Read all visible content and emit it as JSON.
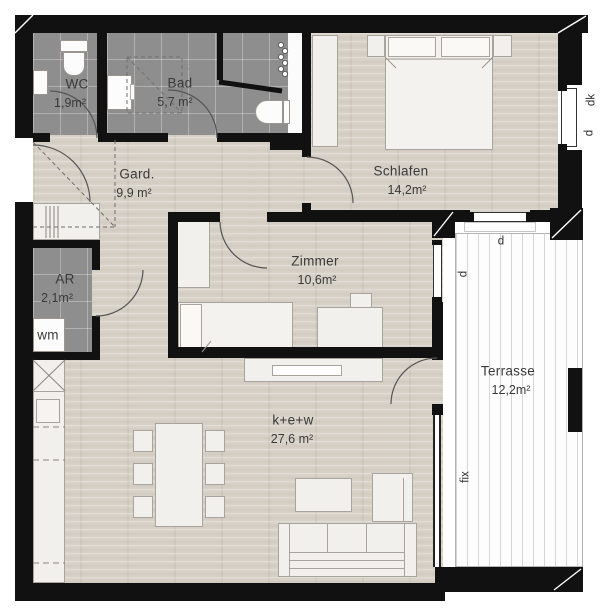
{
  "rooms": [
    {
      "id": "wc",
      "name": "WC",
      "area": "1,9m²"
    },
    {
      "id": "bad",
      "name": "Bad",
      "area": "5,7 m²"
    },
    {
      "id": "gard",
      "name": "Gard.",
      "area": "9,9 m²"
    },
    {
      "id": "schlafen",
      "name": "Schlafen",
      "area": "14,2m²"
    },
    {
      "id": "ar",
      "name": "AR",
      "area": "2,1m²"
    },
    {
      "id": "zimmer",
      "name": "Zimmer",
      "area": "10,6m²"
    },
    {
      "id": "kew",
      "name": "k+e+w",
      "area": "27,6 m²"
    },
    {
      "id": "terrasse",
      "name": "Terrasse",
      "area": "12,2m²"
    }
  ],
  "fixtures": {
    "shower_size": "120/120",
    "washing_machine": "wm"
  },
  "window_labels": {
    "turn_tilt": "dk",
    "turn": "d",
    "fixed": "fix"
  },
  "colors": {
    "wall": "#111111",
    "tile_floor": "#8e8e8e",
    "wood_floor": "#d8d2c8",
    "terrace_floor": "#fdfdfd",
    "furniture": "#f2f0ec"
  }
}
